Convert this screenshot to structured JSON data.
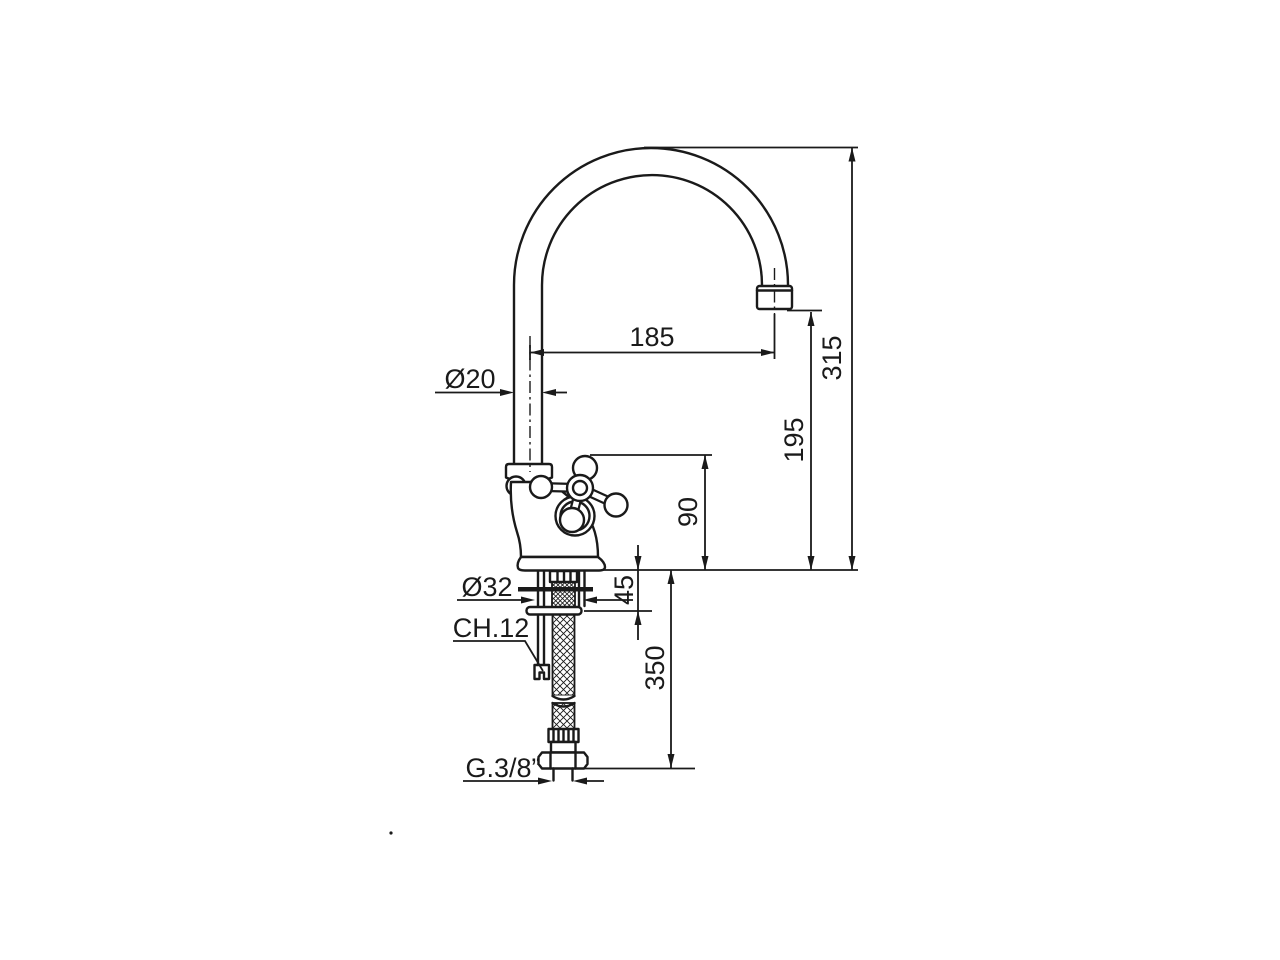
{
  "drawing": {
    "ink_color": "#1a1a1a",
    "background_color": "#ffffff",
    "labels": {
      "spout_reach": "185",
      "overall_height": "315",
      "outlet_height": "195",
      "body_height": "90",
      "spout_diameter": "Ø20",
      "shank_diameter": "Ø32",
      "deck_thickness": "45",
      "hex_size": "CH.12",
      "hose_length": "350",
      "thread": "G.3/8”"
    }
  }
}
